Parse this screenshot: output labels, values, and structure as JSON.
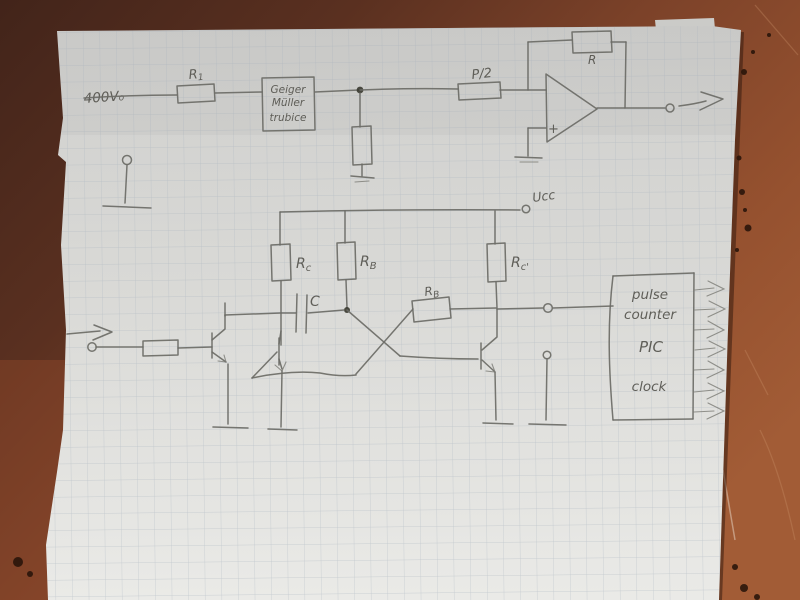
{
  "colors": {
    "surface_dark": "#42241a",
    "surface_mid": "#7c4229",
    "surface_light": "#a25c36",
    "paper": "#d8d8d5",
    "grid": "#a8b2bc",
    "pencil": "#6b6b66"
  },
  "top_circuit": {
    "hv_label": {
      "main": "400V",
      "sub": "o"
    },
    "r1_label": {
      "main": "R",
      "sub": "1"
    },
    "geiger_box": {
      "line1": "Geiger",
      "line2": "Müller",
      "line3": "trubice"
    },
    "pot_label": "P/2",
    "feedback_label": "R",
    "opamp_plus": "+"
  },
  "lower_circuit": {
    "vcc_label": "Ucc",
    "rc_left": {
      "main": "R",
      "sub": "c"
    },
    "rb_left": {
      "main": "R",
      "sub": "B"
    },
    "rc_right": {
      "main": "R",
      "sub": "c'"
    },
    "cap_label": "C",
    "rb_coupling": {
      "main": "R",
      "sub": "B"
    },
    "counter_box": {
      "line1": "pulse",
      "line2": "counter",
      "line3": "PIC",
      "line4": "clock"
    }
  }
}
